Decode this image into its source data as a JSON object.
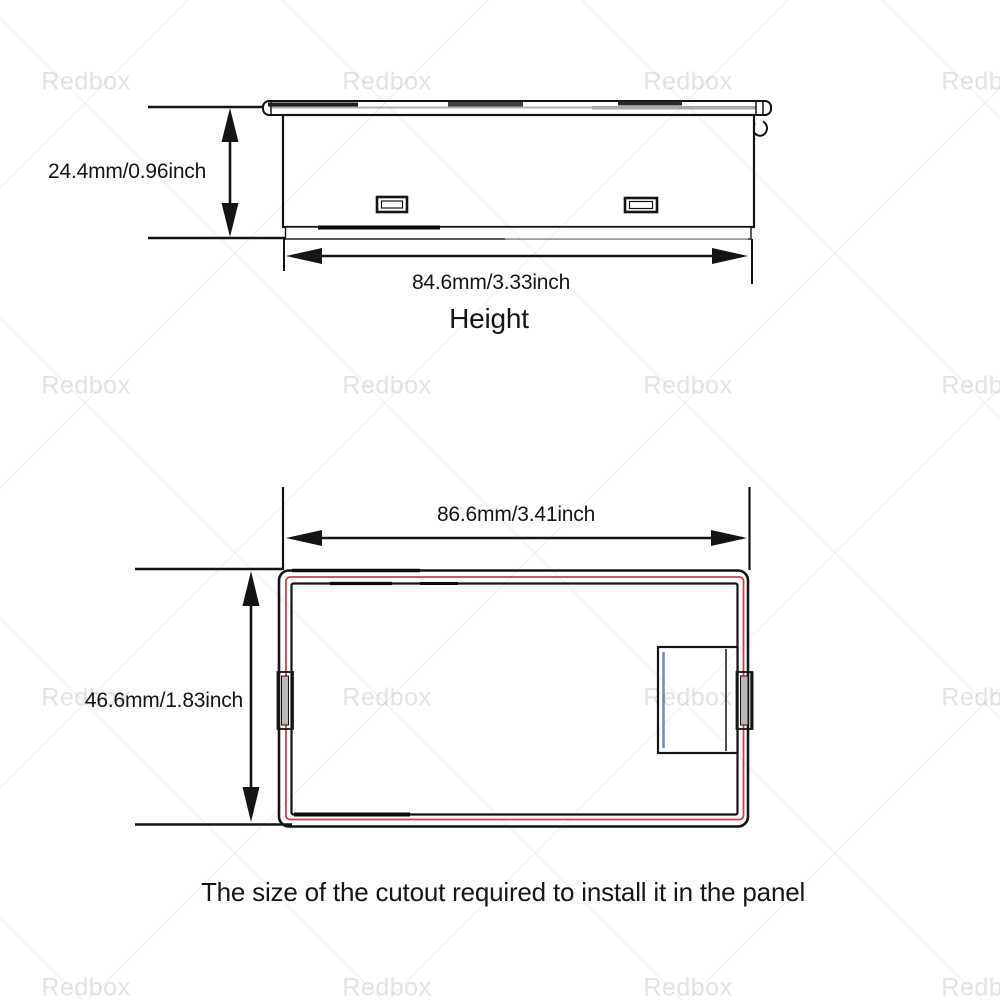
{
  "watermark": {
    "text": "Redbox"
  },
  "colors": {
    "drawing_line": "#141414",
    "cutout_red": "#c8404a",
    "connector_blue": "#7e88c6",
    "watermark_gray": "#e4e4e4"
  },
  "top_view": {
    "height_dim": "24.4mm/0.96inch",
    "width_dim": "84.6mm/3.33inch",
    "label": "Height"
  },
  "cutout_view": {
    "width_dim": "86.6mm/3.41inch",
    "height_dim": "46.6mm/1.83inch"
  },
  "caption": "The size of the cutout required to install it in the panel"
}
